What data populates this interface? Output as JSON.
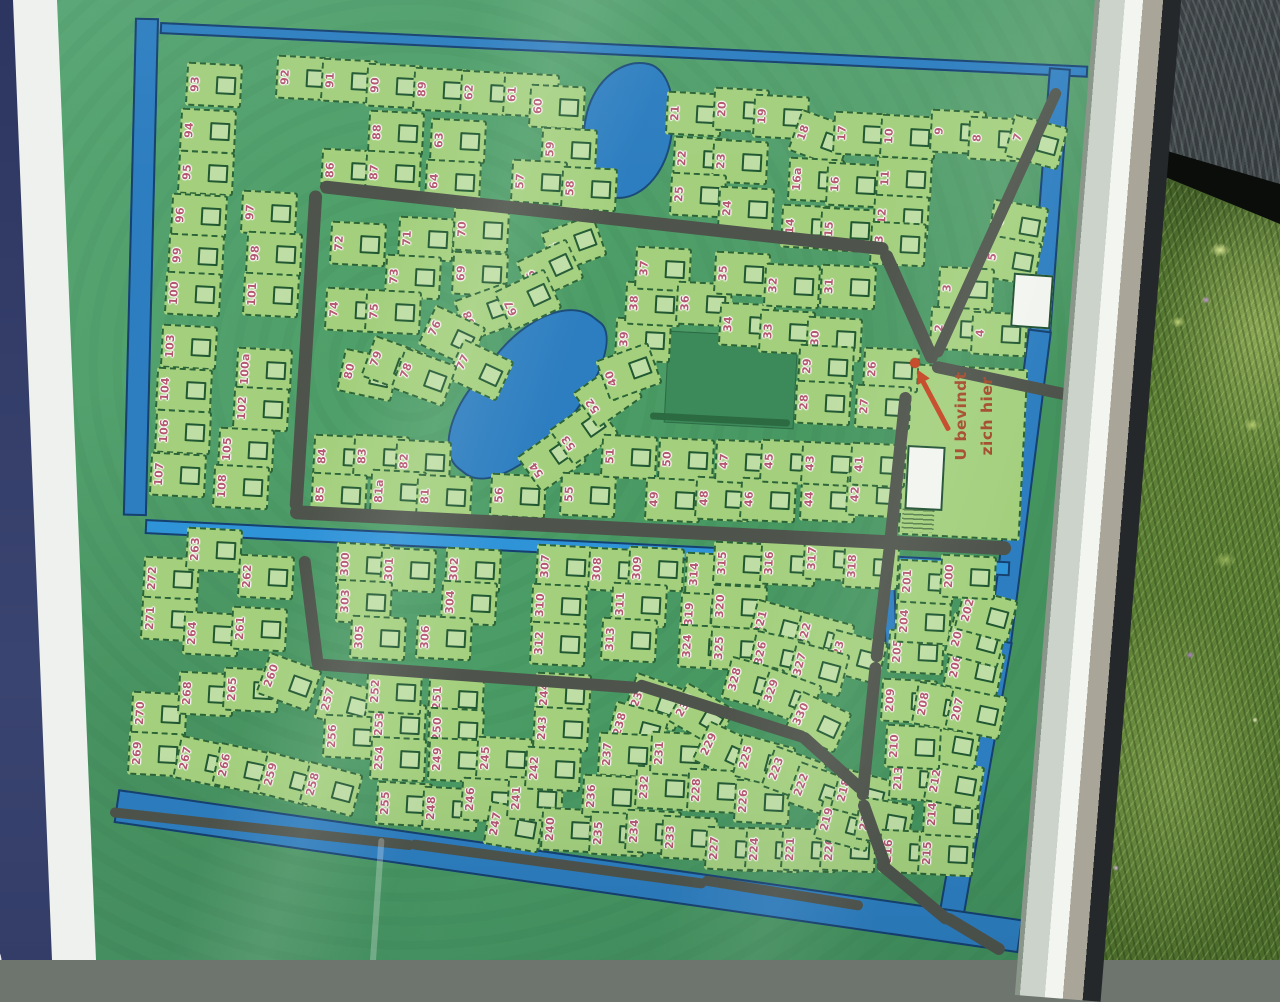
{
  "banner": {
    "text": "galowpark de T"
  },
  "marker": {
    "line1": "U bevindt",
    "line2": "zich hier"
  },
  "map": {
    "colors": {
      "map_green": "#4b9c66",
      "plot_green": "#a4d07e",
      "plot_border": "#2b6437",
      "road_gray": "#4e544b",
      "canal_blue": "#2d7ec0",
      "canal_bright": "#2f93d8",
      "number_rose": "#b4586f",
      "marker_red": "#c34422",
      "marker_text": "#a34b2c",
      "banner_navy": "#333d68"
    },
    "plots": [
      [
        "93",
        198,
        84
      ],
      [
        "92",
        288,
        77
      ],
      [
        "91",
        333,
        80
      ],
      [
        "90",
        378,
        85
      ],
      [
        "89",
        425,
        89
      ],
      [
        "62",
        472,
        92
      ],
      [
        "61",
        515,
        94
      ],
      [
        "60",
        541,
        106
      ],
      [
        "94",
        192,
        130
      ],
      [
        "88",
        380,
        132
      ],
      [
        "63",
        442,
        140
      ],
      [
        "59",
        553,
        149
      ],
      [
        "95",
        190,
        172
      ],
      [
        "86",
        333,
        170
      ],
      [
        "87",
        377,
        172
      ],
      [
        "64",
        437,
        181
      ],
      [
        "57",
        523,
        181
      ],
      [
        "58",
        573,
        188
      ],
      [
        "96",
        183,
        215
      ],
      [
        "97",
        253,
        212
      ],
      [
        "72",
        342,
        243
      ],
      [
        "71",
        410,
        238
      ],
      [
        "70",
        465,
        229
      ],
      [
        "65",
        558,
        243,
        -20
      ],
      [
        "99",
        180,
        255
      ],
      [
        "98",
        258,
        253
      ],
      [
        "73",
        397,
        276
      ],
      [
        "69",
        464,
        273
      ],
      [
        "66",
        534,
        269,
        -25
      ],
      [
        "100",
        177,
        293
      ],
      [
        "101",
        255,
        294
      ],
      [
        "74",
        337,
        309
      ],
      [
        "75",
        377,
        311
      ],
      [
        "68",
        471,
        311,
        -20
      ],
      [
        "67",
        512,
        299,
        -25
      ],
      [
        "103",
        173,
        346
      ],
      [
        "100a",
        248,
        369
      ],
      [
        "104",
        168,
        389
      ],
      [
        "102",
        245,
        408
      ],
      [
        "106",
        167,
        431
      ],
      [
        "105",
        230,
        449
      ],
      [
        "107",
        162,
        474
      ],
      [
        "108",
        225,
        486
      ],
      [
        "76",
        436,
        335,
        25
      ],
      [
        "77",
        464,
        369,
        25
      ],
      [
        "80",
        352,
        374,
        12
      ],
      [
        "79",
        378,
        364,
        20
      ],
      [
        "78",
        408,
        376,
        20
      ],
      [
        "84",
        325,
        456
      ],
      [
        "83",
        365,
        456
      ],
      [
        "82",
        407,
        461
      ],
      [
        "85",
        323,
        494
      ],
      [
        "81a",
        382,
        491
      ],
      [
        "81",
        428,
        496
      ],
      [
        "56",
        502,
        495
      ],
      [
        "54",
        536,
        458,
        -35
      ],
      [
        "53",
        568,
        431,
        -35
      ],
      [
        "52",
        592,
        394,
        -35
      ],
      [
        "55",
        572,
        494
      ],
      [
        "51",
        613,
        456
      ],
      [
        "50",
        670,
        459
      ],
      [
        "49",
        657,
        499
      ],
      [
        "48",
        707,
        498
      ],
      [
        "47",
        727,
        461
      ],
      [
        "46",
        752,
        499
      ],
      [
        "45",
        772,
        461
      ],
      [
        "44",
        812,
        499
      ],
      [
        "43",
        813,
        463
      ],
      [
        "42",
        858,
        494
      ],
      [
        "41",
        862,
        464
      ],
      [
        "39",
        627,
        339
      ],
      [
        "40",
        613,
        371,
        -20
      ],
      [
        "38",
        637,
        303
      ],
      [
        "37",
        647,
        268
      ],
      [
        "36",
        688,
        303
      ],
      [
        "35",
        726,
        273
      ],
      [
        "34",
        731,
        324
      ],
      [
        "33",
        771,
        331
      ],
      [
        "32",
        776,
        285
      ],
      [
        "31",
        832,
        286
      ],
      [
        "30",
        818,
        338
      ],
      [
        "29",
        810,
        366
      ],
      [
        "28",
        807,
        402
      ],
      [
        "26",
        875,
        369
      ],
      [
        "27",
        867,
        406
      ],
      [
        "21",
        678,
        113
      ],
      [
        "20",
        725,
        109
      ],
      [
        "19",
        765,
        116
      ],
      [
        "18",
        805,
        138,
        20
      ],
      [
        "17",
        845,
        133
      ],
      [
        "22",
        685,
        158
      ],
      [
        "23",
        724,
        161
      ],
      [
        "16a",
        800,
        179
      ],
      [
        "16",
        838,
        184
      ],
      [
        "25",
        682,
        194
      ],
      [
        "24",
        730,
        208
      ],
      [
        "14",
        793,
        226
      ],
      [
        "15",
        832,
        229
      ],
      [
        "11",
        888,
        178
      ],
      [
        "12",
        885,
        216
      ],
      [
        "13",
        882,
        243
      ],
      [
        "10",
        892,
        136
      ],
      [
        "9",
        942,
        131
      ],
      [
        "8",
        980,
        138
      ],
      [
        "7",
        1020,
        141,
        15
      ],
      [
        "6",
        1002,
        224,
        10
      ],
      [
        "5",
        995,
        259,
        10
      ],
      [
        "3",
        950,
        288
      ],
      [
        "2",
        942,
        328
      ],
      [
        "4",
        983,
        333
      ],
      [
        "272",
        155,
        578
      ],
      [
        "263",
        198,
        549
      ],
      [
        "262",
        250,
        576
      ],
      [
        "271",
        153,
        618
      ],
      [
        "264",
        195,
        633
      ],
      [
        "261",
        243,
        628
      ],
      [
        "270",
        143,
        713
      ],
      [
        "268",
        190,
        693
      ],
      [
        "265",
        235,
        689
      ],
      [
        "260",
        273,
        681,
        20
      ],
      [
        "269",
        140,
        753
      ],
      [
        "267",
        188,
        761,
        12
      ],
      [
        "266",
        227,
        768,
        12
      ],
      [
        "259",
        273,
        778,
        15
      ],
      [
        "258",
        315,
        788,
        15
      ],
      [
        "257",
        330,
        703,
        15
      ],
      [
        "256",
        335,
        736
      ],
      [
        "253",
        382,
        724
      ],
      [
        "252",
        378,
        691
      ],
      [
        "254",
        382,
        758
      ],
      [
        "255",
        388,
        803
      ],
      [
        "251",
        440,
        698
      ],
      [
        "250",
        440,
        729
      ],
      [
        "249",
        440,
        759
      ],
      [
        "248",
        434,
        808
      ],
      [
        "245",
        488,
        758
      ],
      [
        "246",
        473,
        799
      ],
      [
        "247",
        498,
        826,
        10
      ],
      [
        "241",
        519,
        798
      ],
      [
        "240",
        553,
        829
      ],
      [
        "244",
        547,
        694
      ],
      [
        "243",
        545,
        728
      ],
      [
        "242",
        537,
        768
      ],
      [
        "239",
        640,
        701,
        20
      ],
      [
        "238",
        622,
        728,
        15
      ],
      [
        "237",
        610,
        754
      ],
      [
        "236",
        594,
        796
      ],
      [
        "235",
        601,
        833
      ],
      [
        "234",
        637,
        831
      ],
      [
        "233",
        673,
        837
      ],
      [
        "232",
        647,
        787
      ],
      [
        "231",
        662,
        753
      ],
      [
        "230",
        685,
        714,
        30
      ],
      [
        "229",
        710,
        751,
        25
      ],
      [
        "228",
        699,
        790
      ],
      [
        "227",
        717,
        848
      ],
      [
        "226",
        746,
        801
      ],
      [
        "225",
        748,
        761,
        15
      ],
      [
        "224",
        757,
        849
      ],
      [
        "223",
        778,
        774,
        20
      ],
      [
        "222",
        803,
        790,
        20
      ],
      [
        "221",
        793,
        849
      ],
      [
        "220",
        832,
        849
      ],
      [
        "219",
        829,
        823,
        15
      ],
      [
        "218",
        846,
        794,
        15
      ],
      [
        "217",
        868,
        821,
        10
      ],
      [
        "216",
        891,
        851
      ],
      [
        "215",
        930,
        853
      ],
      [
        "214",
        935,
        814
      ],
      [
        "213",
        901,
        778
      ],
      [
        "212",
        938,
        783,
        10
      ],
      [
        "211",
        935,
        743,
        10
      ],
      [
        "210",
        897,
        746
      ],
      [
        "209",
        893,
        700
      ],
      [
        "208",
        926,
        706,
        10
      ],
      [
        "207",
        960,
        712,
        12
      ],
      [
        "206",
        958,
        669,
        12
      ],
      [
        "205",
        900,
        651
      ],
      [
        "204",
        907,
        621
      ],
      [
        "203",
        960,
        639,
        15
      ],
      [
        "202",
        970,
        614,
        15
      ],
      [
        "201",
        910,
        581
      ],
      [
        "200",
        952,
        576
      ],
      [
        "300",
        348,
        564
      ],
      [
        "301",
        392,
        569
      ],
      [
        "302",
        457,
        569
      ],
      [
        "303",
        348,
        601
      ],
      [
        "304",
        453,
        602
      ],
      [
        "305",
        362,
        637
      ],
      [
        "306",
        428,
        637
      ],
      [
        "307",
        548,
        566
      ],
      [
        "308",
        600,
        569
      ],
      [
        "309",
        640,
        568
      ],
      [
        "310",
        543,
        605
      ],
      [
        "311",
        623,
        604
      ],
      [
        "312",
        542,
        643
      ],
      [
        "313",
        613,
        639
      ],
      [
        "314",
        697,
        574
      ],
      [
        "315",
        725,
        563
      ],
      [
        "316",
        772,
        563
      ],
      [
        "317",
        815,
        558
      ],
      [
        "318",
        855,
        566
      ],
      [
        "319",
        692,
        614
      ],
      [
        "320",
        723,
        606
      ],
      [
        "321",
        763,
        626,
        15
      ],
      [
        "322",
        807,
        638,
        15
      ],
      [
        "323",
        840,
        656,
        15
      ],
      [
        "324",
        690,
        646
      ],
      [
        "325",
        722,
        648
      ],
      [
        "326",
        763,
        656,
        12
      ],
      [
        "327",
        802,
        668,
        15
      ],
      [
        "328",
        737,
        683,
        15
      ],
      [
        "329",
        773,
        696,
        20
      ],
      [
        "330",
        802,
        721,
        25
      ]
    ]
  }
}
